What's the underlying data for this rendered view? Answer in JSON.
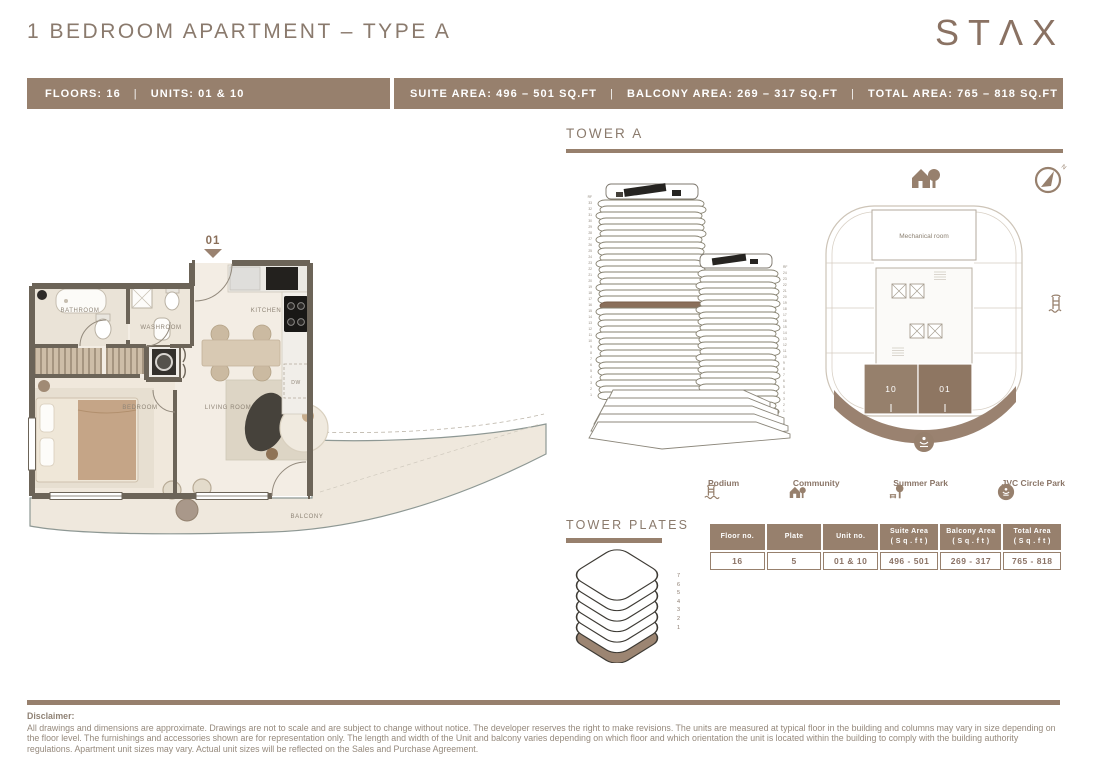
{
  "brand": "STΛX",
  "page": {
    "title": "1 BEDROOM APARTMENT – TYPE A"
  },
  "info_bar": {
    "floors": "FLOORS: 16",
    "sep": "|",
    "units": "UNITS: 01 & 10",
    "suite": "SUITE AREA: 496 – 501 SQ.FT",
    "balcony": "BALCONY AREA: 269 – 317 SQ.FT",
    "total": "TOTAL AREA: 765 – 818 SQ.FT"
  },
  "floor_plan": {
    "entry_unit": "01",
    "rooms": {
      "bathroom": "BATHROOM",
      "washroom": "WASHROOM",
      "kitchen": "KITCHEN",
      "bedroom": "BEDROOM",
      "living_room": "LIVING ROOM",
      "balcony": "BALCONY",
      "dw": "DW"
    }
  },
  "tower_section": {
    "heading": "TOWER A",
    "compass_n": "N",
    "plate": {
      "mechanical_room": "Mechanical room",
      "unit_left": "10",
      "unit_right": "01"
    },
    "left_tower_floors": [
      "RF",
      "33",
      "32",
      "31",
      "30",
      "29",
      "28",
      "27",
      "26",
      "25",
      "24",
      "23",
      "22",
      "21",
      "20",
      "19",
      "18",
      "17",
      "16",
      "15",
      "14",
      "13",
      "12",
      "11",
      "10",
      "9",
      "8",
      "7",
      "6",
      "5",
      "4",
      "3",
      "2",
      "1"
    ],
    "right_tower_floors": [
      "RF",
      "24",
      "23",
      "22",
      "21",
      "20",
      "19",
      "18",
      "17",
      "16",
      "15",
      "14",
      "13",
      "12",
      "11",
      "10",
      "9",
      "8",
      "7",
      "6",
      "5",
      "4",
      "3",
      "2",
      "1"
    ],
    "highlight_floor": "16"
  },
  "legend": {
    "items": [
      {
        "label": "Podium",
        "icon": "podium-icon"
      },
      {
        "label": "Community",
        "icon": "community-icon"
      },
      {
        "label": "Summer Park",
        "icon": "summer-park-icon"
      },
      {
        "label": "JVC Circle Park",
        "icon": "jvc-circle-park-icon"
      }
    ]
  },
  "tower_plates": {
    "heading": "TOWER PLATES",
    "levels": [
      "7",
      "6",
      "5",
      "4",
      "3",
      "2",
      "1"
    ]
  },
  "table": {
    "headers": [
      "Floor no.",
      "Plate",
      "Unit no.",
      "Suite Area\n( S q . f t )",
      "Balcony Area\n( S q . f t )",
      "Total Area\n( S q . f t )"
    ],
    "rows": [
      [
        "16",
        "5",
        "01 & 10",
        "496 - 501",
        "269 - 317",
        "765 - 818"
      ]
    ]
  },
  "disclaimer": {
    "label": "Disclaimer:",
    "text": "All drawings and dimensions are approximate. Drawings are not to scale and are subject to change without notice. The developer reserves the right to make revisions. The units are measured at typical floor in the building and columns may vary in size depending on the floor level. The furnishings and accessories shown are for representation only. The length and width of the Unit and balcony varies depending on which floor and which orientation the unit is located within the building to comply with the building authority regulations. Apartment unit sizes may vary. Actual unit sizes will be reflected on the Sales and Purchase Agreement."
  },
  "colors": {
    "brand_brown": "#97806d",
    "highlight_brown": "#8a6f5a",
    "wall": "#6c6458",
    "text_brown": "#8a7a6d",
    "floor_cream": "#f3ede4"
  }
}
